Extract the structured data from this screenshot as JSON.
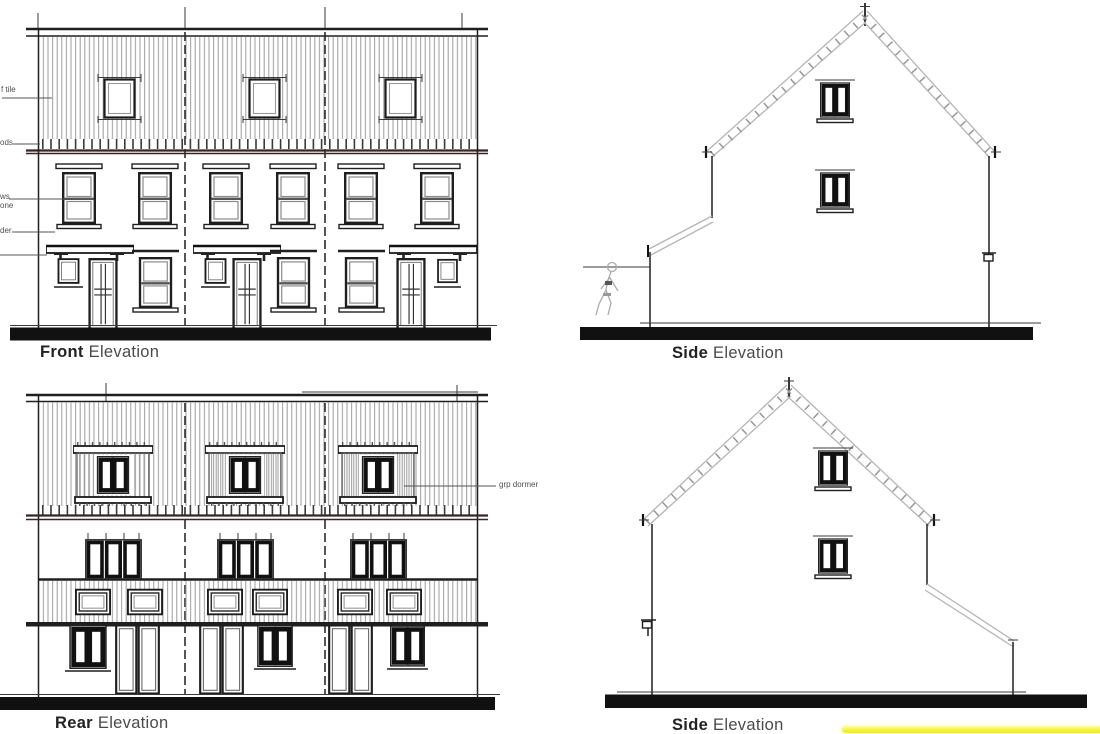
{
  "sheet": {
    "background": "#ffffff",
    "highlight_color": "#f4f428",
    "line_color_dark": "#1f1f1f",
    "line_color_hatch": "#9c9c9c",
    "line_color_roof": "#b5b5b5"
  },
  "labels": {
    "front": {
      "bold": "Front",
      "rest": "Elevation"
    },
    "side_top": {
      "bold": "Side",
      "rest": "Elevation"
    },
    "rear": {
      "bold": "Rear",
      "rest": "Elevation"
    },
    "side_bottom": {
      "bold": "Side",
      "rest": "Elevation"
    }
  },
  "annotations": {
    "left_edge": [
      {
        "text": "f tile"
      },
      {
        "text": "ods"
      },
      {
        "text": "ws"
      },
      {
        "text": "one"
      },
      {
        "text": "der"
      }
    ],
    "grp_dormer": "grp dormer"
  }
}
